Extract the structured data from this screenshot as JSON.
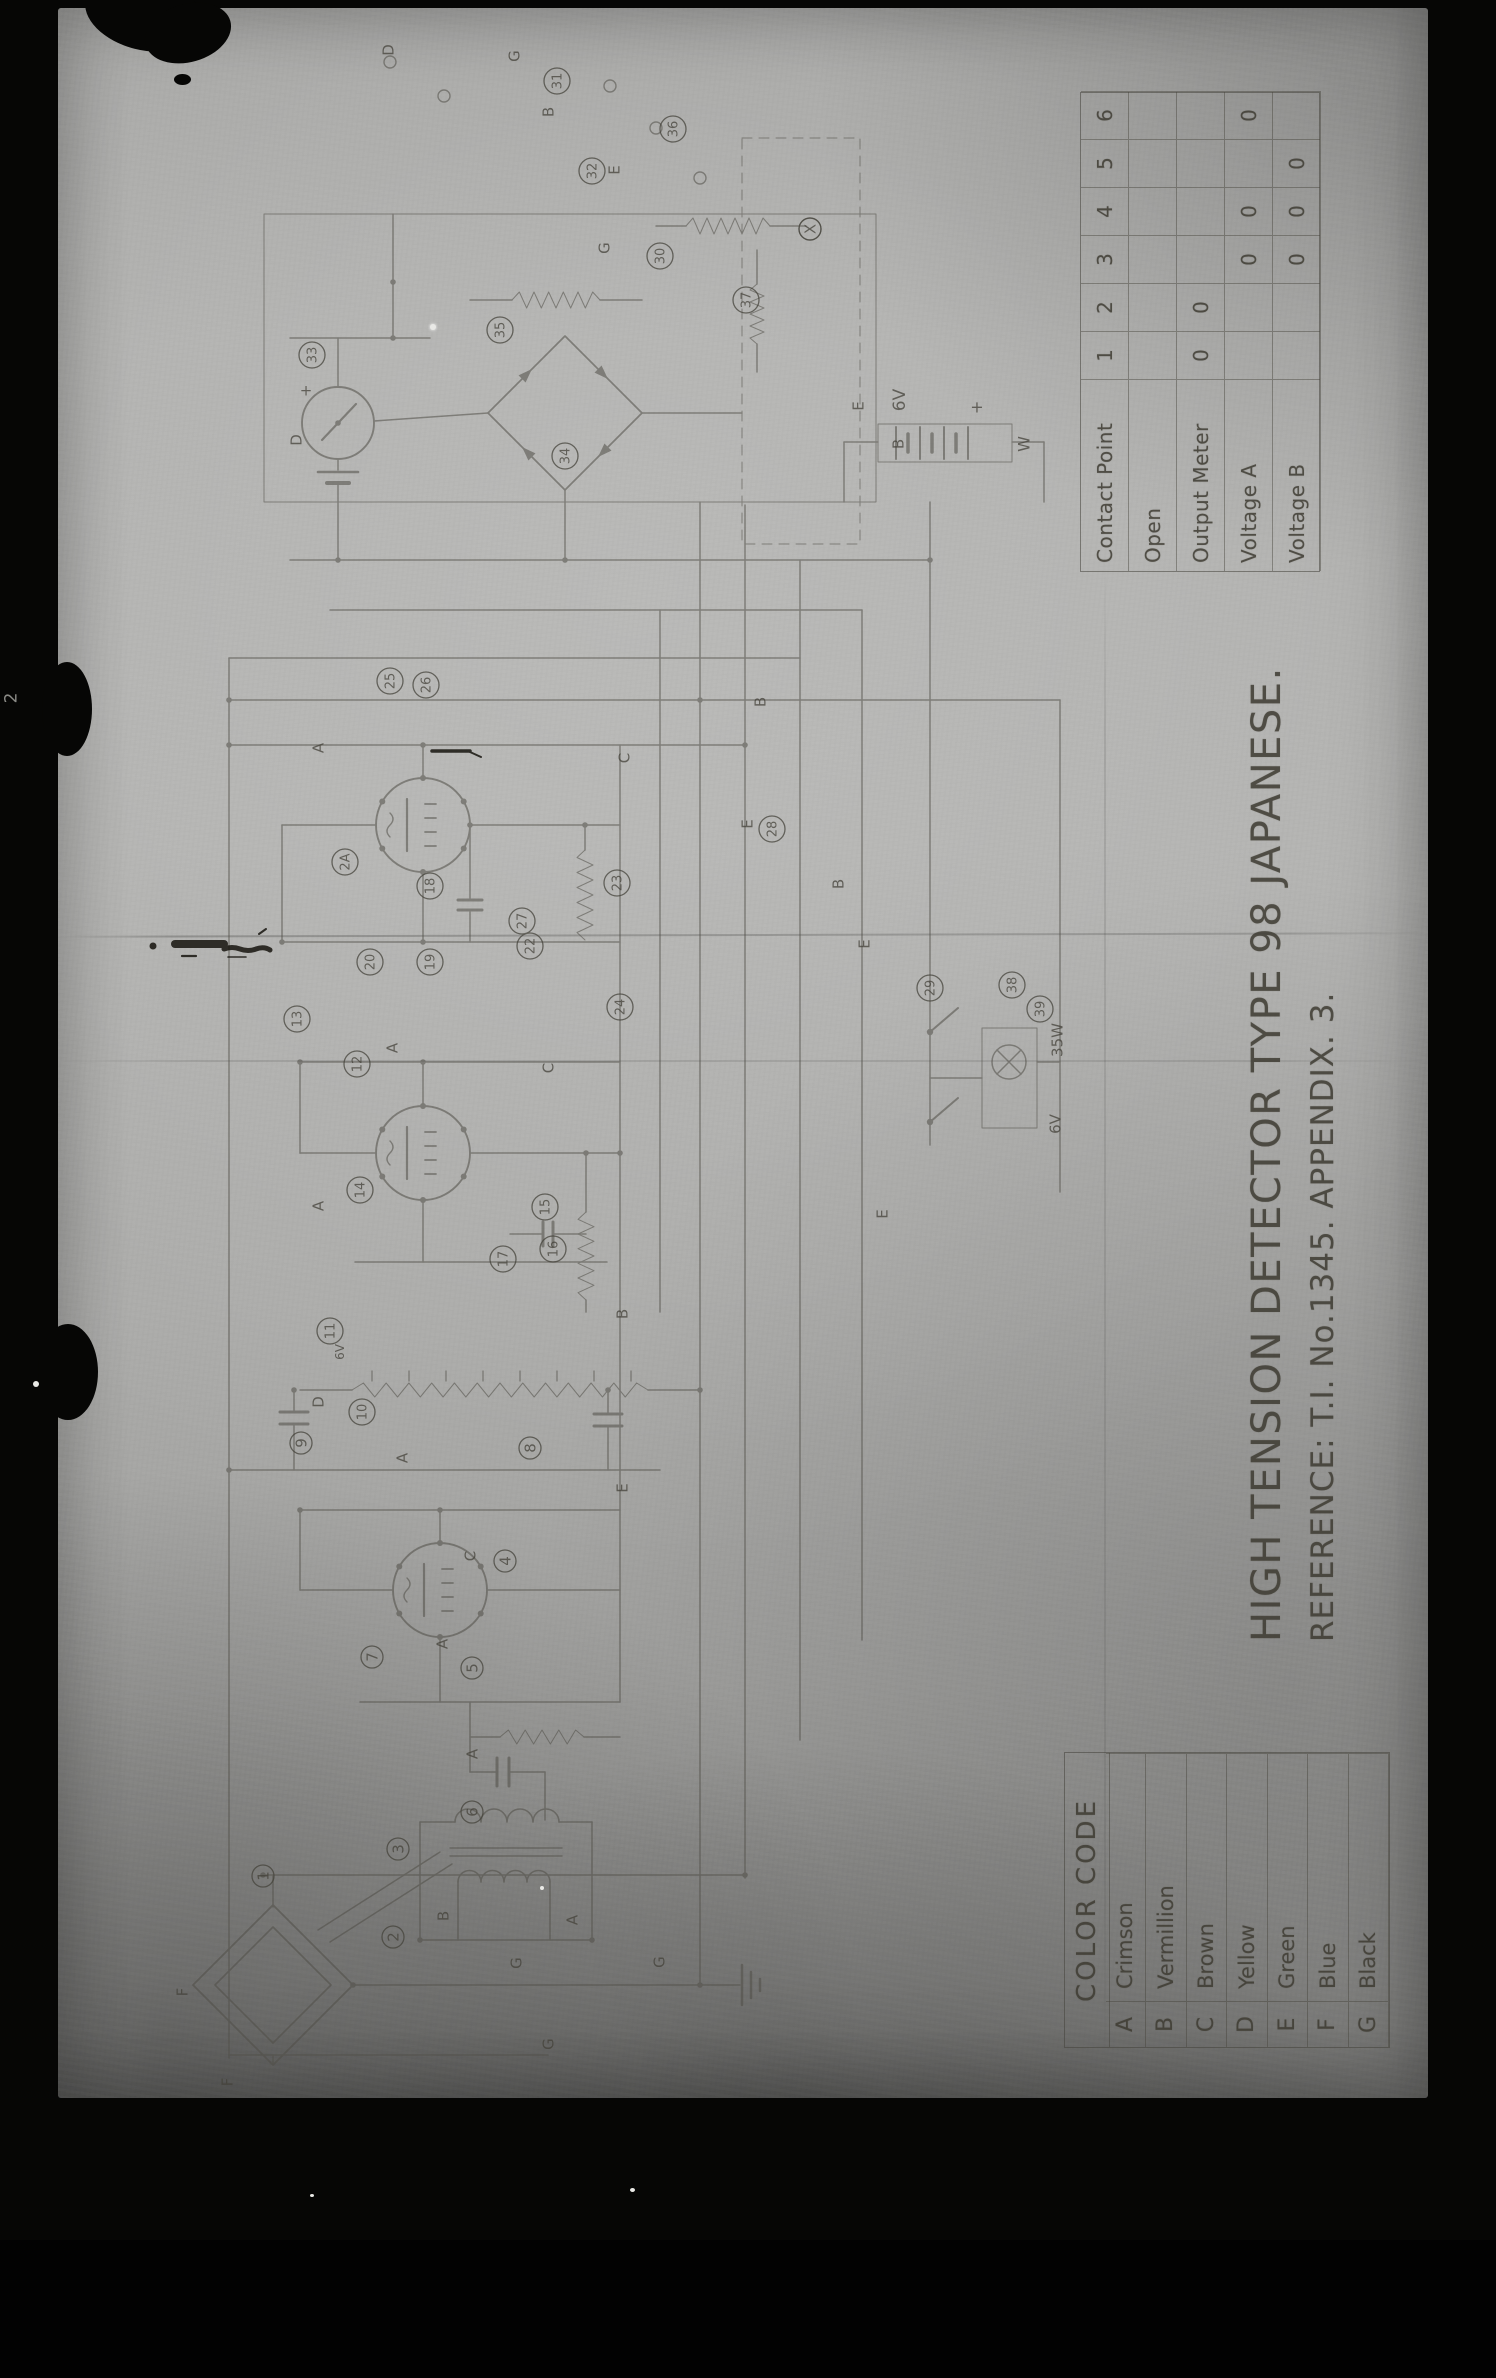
{
  "photo": {
    "title": "HIGH TENSION DETECTOR TYPE 98 JAPANESE.",
    "reference": "REFERENCE: T.I. No.1345.  APPENDIX. 3.",
    "edge_mark": "2"
  },
  "contact_table": {
    "header_label": "Contact Point",
    "contacts": [
      "1",
      "2",
      "3",
      "4",
      "5",
      "6"
    ],
    "rows": [
      {
        "label": "Open",
        "values": [
          "",
          "",
          "",
          "",
          "",
          ""
        ]
      },
      {
        "label": "Output Meter",
        "values": [
          "0",
          "0",
          "",
          "",
          "",
          ""
        ]
      },
      {
        "label": "Voltage A",
        "values": [
          "",
          "",
          "0",
          "0",
          "",
          "0"
        ]
      },
      {
        "label": "Voltage B",
        "values": [
          "",
          "",
          "0",
          "0",
          "0",
          ""
        ]
      }
    ]
  },
  "color_code": {
    "title": "COLOR CODE",
    "rows": [
      {
        "code": "A",
        "name": "Crimson"
      },
      {
        "code": "B",
        "name": "Vermillion"
      },
      {
        "code": "C",
        "name": "Brown"
      },
      {
        "code": "D",
        "name": "Yellow"
      },
      {
        "code": "E",
        "name": "Green"
      },
      {
        "code": "F",
        "name": "Blue"
      },
      {
        "code": "G",
        "name": "Black"
      }
    ]
  },
  "schematic": {
    "ink": "#4a483f",
    "component_numbers": [
      {
        "t": "1",
        "x": 263,
        "y": 1876
      },
      {
        "t": "2",
        "x": 393,
        "y": 1937
      },
      {
        "t": "3",
        "x": 398,
        "y": 1849
      },
      {
        "t": "4",
        "x": 505,
        "y": 1561
      },
      {
        "t": "5",
        "x": 472,
        "y": 1668
      },
      {
        "t": "6",
        "x": 472,
        "y": 1812
      },
      {
        "t": "7",
        "x": 372,
        "y": 1657
      },
      {
        "t": "8",
        "x": 530,
        "y": 1448
      },
      {
        "t": "9",
        "x": 301,
        "y": 1443
      },
      {
        "t": "10",
        "x": 362,
        "y": 1412
      },
      {
        "t": "11",
        "x": 330,
        "y": 1331
      },
      {
        "t": "12",
        "x": 357,
        "y": 1064
      },
      {
        "t": "13",
        "x": 297,
        "y": 1019
      },
      {
        "t": "14",
        "x": 360,
        "y": 1190
      },
      {
        "t": "15",
        "x": 545,
        "y": 1207
      },
      {
        "t": "16",
        "x": 553,
        "y": 1249
      },
      {
        "t": "17",
        "x": 503,
        "y": 1259
      },
      {
        "t": "18",
        "x": 430,
        "y": 886
      },
      {
        "t": "19",
        "x": 430,
        "y": 962
      },
      {
        "t": "20",
        "x": 370,
        "y": 962
      },
      {
        "t": "2A",
        "x": 345,
        "y": 862
      },
      {
        "t": "22",
        "x": 530,
        "y": 946
      },
      {
        "t": "23",
        "x": 617,
        "y": 883
      },
      {
        "t": "24",
        "x": 620,
        "y": 1007
      },
      {
        "t": "25",
        "x": 390,
        "y": 681
      },
      {
        "t": "26",
        "x": 426,
        "y": 685
      },
      {
        "t": "27",
        "x": 522,
        "y": 921
      },
      {
        "t": "28",
        "x": 772,
        "y": 829
      },
      {
        "t": "29",
        "x": 930,
        "y": 988
      },
      {
        "t": "30",
        "x": 660,
        "y": 256
      },
      {
        "t": "31",
        "x": 557,
        "y": 81
      },
      {
        "t": "32",
        "x": 592,
        "y": 171
      },
      {
        "t": "33",
        "x": 312,
        "y": 355
      },
      {
        "t": "34",
        "x": 565,
        "y": 456
      },
      {
        "t": "35",
        "x": 500,
        "y": 330
      },
      {
        "t": "36",
        "x": 673,
        "y": 129
      },
      {
        "t": "37",
        "x": 746,
        "y": 300
      },
      {
        "t": "38",
        "x": 1012,
        "y": 985
      },
      {
        "t": "39",
        "x": 1040,
        "y": 1009
      },
      {
        "t": "X",
        "x": 810,
        "y": 229
      }
    ],
    "wire_letters": [
      {
        "t": "D",
        "x": 388,
        "y": 50
      },
      {
        "t": "G",
        "x": 514,
        "y": 56
      },
      {
        "t": "B",
        "x": 548,
        "y": 112
      },
      {
        "t": "E",
        "x": 614,
        "y": 170
      },
      {
        "t": "G",
        "x": 604,
        "y": 248
      },
      {
        "t": "D",
        "x": 296,
        "y": 440
      },
      {
        "t": "A",
        "x": 318,
        "y": 748
      },
      {
        "t": "C",
        "x": 624,
        "y": 758
      },
      {
        "t": "B",
        "x": 760,
        "y": 702
      },
      {
        "t": "E",
        "x": 747,
        "y": 824
      },
      {
        "t": "B",
        "x": 838,
        "y": 884
      },
      {
        "t": "E",
        "x": 864,
        "y": 944
      },
      {
        "t": "A",
        "x": 392,
        "y": 1048
      },
      {
        "t": "C",
        "x": 548,
        "y": 1068
      },
      {
        "t": "E",
        "x": 882,
        "y": 1214
      },
      {
        "t": "B",
        "x": 622,
        "y": 1314
      },
      {
        "t": "A",
        "x": 318,
        "y": 1206
      },
      {
        "t": "D",
        "x": 318,
        "y": 1402
      },
      {
        "t": "A",
        "x": 402,
        "y": 1458
      },
      {
        "t": "E",
        "x": 622,
        "y": 1488
      },
      {
        "t": "A",
        "x": 442,
        "y": 1644
      },
      {
        "t": "C",
        "x": 470,
        "y": 1556
      },
      {
        "t": "A",
        "x": 472,
        "y": 1754
      },
      {
        "t": "A",
        "x": 572,
        "y": 1920
      },
      {
        "t": "B",
        "x": 443,
        "y": 1916
      },
      {
        "t": "G",
        "x": 516,
        "y": 1963
      },
      {
        "t": "G",
        "x": 659,
        "y": 1962
      },
      {
        "t": "G",
        "x": 548,
        "y": 2044
      },
      {
        "t": "F",
        "x": 182,
        "y": 1992
      },
      {
        "t": "F",
        "x": 227,
        "y": 2082
      },
      {
        "t": "E",
        "x": 858,
        "y": 406
      },
      {
        "t": "B",
        "x": 898,
        "y": 444
      }
    ],
    "annotations": [
      {
        "t": "6V",
        "x": 899,
        "y": 400,
        "rot": -90,
        "size": 17
      },
      {
        "t": "+",
        "x": 977,
        "y": 407,
        "rot": 0,
        "size": 16
      },
      {
        "t": "W",
        "x": 1024,
        "y": 444,
        "rot": -90,
        "size": 16
      },
      {
        "t": "+",
        "x": 306,
        "y": 390,
        "rot": 0,
        "size": 15
      },
      {
        "t": "35W",
        "x": 1057,
        "y": 1040,
        "rot": -90,
        "size": 15
      },
      {
        "t": "6V",
        "x": 1055,
        "y": 1124,
        "rot": -90,
        "size": 15
      },
      {
        "t": "6V",
        "x": 340,
        "y": 1352,
        "rot": -90,
        "size": 12
      }
    ]
  }
}
